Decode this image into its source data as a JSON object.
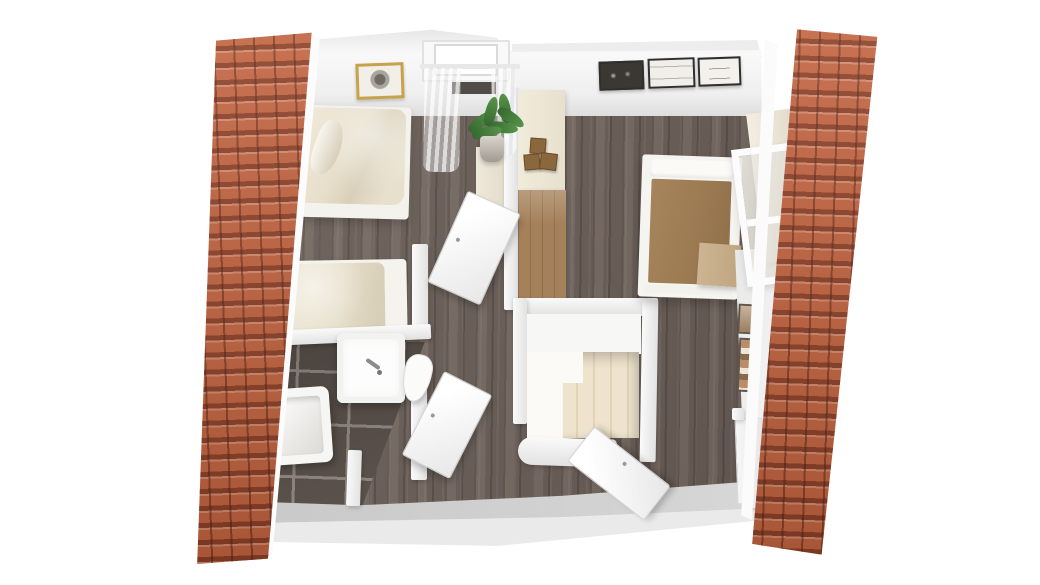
{
  "scene": {
    "type": "3d-floor-plan-render",
    "view": "top-down dollhouse cutaway of an attic floor",
    "background": "#ffffff",
    "visible_text": ""
  },
  "colors": {
    "roof-base": "#c2633f",
    "wall-light": "#fafafa",
    "wall-shadow": "#e2e2e2",
    "wood-base": "#6a5e57",
    "wood-dark": "#584e48",
    "wood-light": "#776b63",
    "tile-base": "#564d46",
    "grout": "#8e867e",
    "duvet": "#e6dec9",
    "blanket": "#9b7a52",
    "stairs": "#eee3cd",
    "dresser": "#a5815a",
    "cabinet": "#efe9da",
    "bottom-wall": "#c8c8c8",
    "gold": "#c8a24a",
    "plant": "#57944a",
    "box": "#8a673c"
  },
  "exterior": {
    "left_roof": "red clay tile roof slope",
    "right_roof": "red clay tile roof slope",
    "front_wall": "gray knee wall along bottom edge"
  },
  "rooms": [
    {
      "name": "bedroom-left",
      "floor": "dark wood planks",
      "furniture": [
        "double-bed-cream-duvet",
        "single-bed-cream-duvet",
        "cream-wardrobe",
        "gold-framed-picture",
        "window-with-sheer-curtains",
        "potted-plant"
      ]
    },
    {
      "name": "bathroom",
      "floor": "dark brown tiles with light grout",
      "furniture": [
        "bathtub",
        "washbasin-vanity-with-faucet",
        "toilet",
        "open-door"
      ]
    },
    {
      "name": "hallway",
      "floor": "dark wood planks",
      "furniture": [
        "cream-counter-with-boxes",
        "wood-dresser",
        "staircase-going-down",
        "open-doors"
      ]
    },
    {
      "name": "bedroom-right",
      "floor": "dark wood planks",
      "furniture": [
        "double-bed-brown-blanket",
        "wardrobe-with-glass-frame",
        "desk",
        "three-wall-frames",
        "two-small-wall-frames",
        "door"
      ]
    }
  ]
}
